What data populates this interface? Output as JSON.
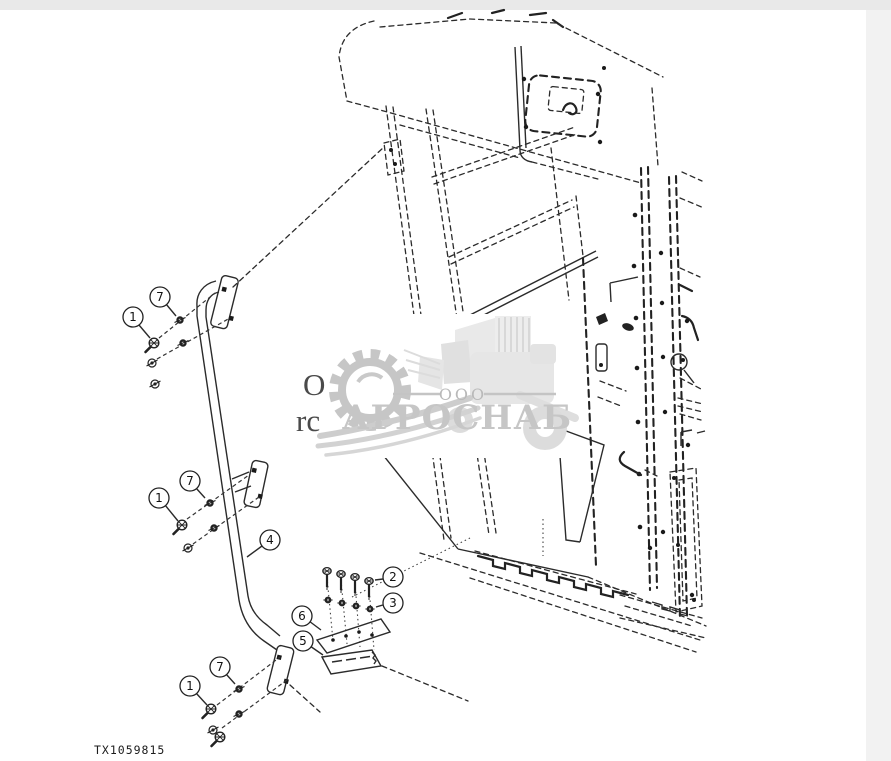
{
  "page": {
    "background": "#ffffff",
    "margin_top_color": "#e9e9e9",
    "margin_right_color": "#f2f2f2"
  },
  "diagram": {
    "drawing_number": "TX1059815",
    "line_color": "#2a2a2a",
    "description": "parts-diagram-handrail-and-steps",
    "callouts": [
      {
        "label": "1"
      },
      {
        "label": "7"
      },
      {
        "label": "1"
      },
      {
        "label": "7"
      },
      {
        "label": "4"
      },
      {
        "label": "1"
      },
      {
        "label": "7"
      },
      {
        "label": "2"
      },
      {
        "label": "3"
      },
      {
        "label": "6"
      },
      {
        "label": "5"
      }
    ],
    "text_fragments": {
      "left_upper": "O",
      "left_lower": "rc"
    }
  },
  "watermark": {
    "org_form": "ООО",
    "name": "АГРОСНАБ",
    "color": "#c6c6c6"
  }
}
